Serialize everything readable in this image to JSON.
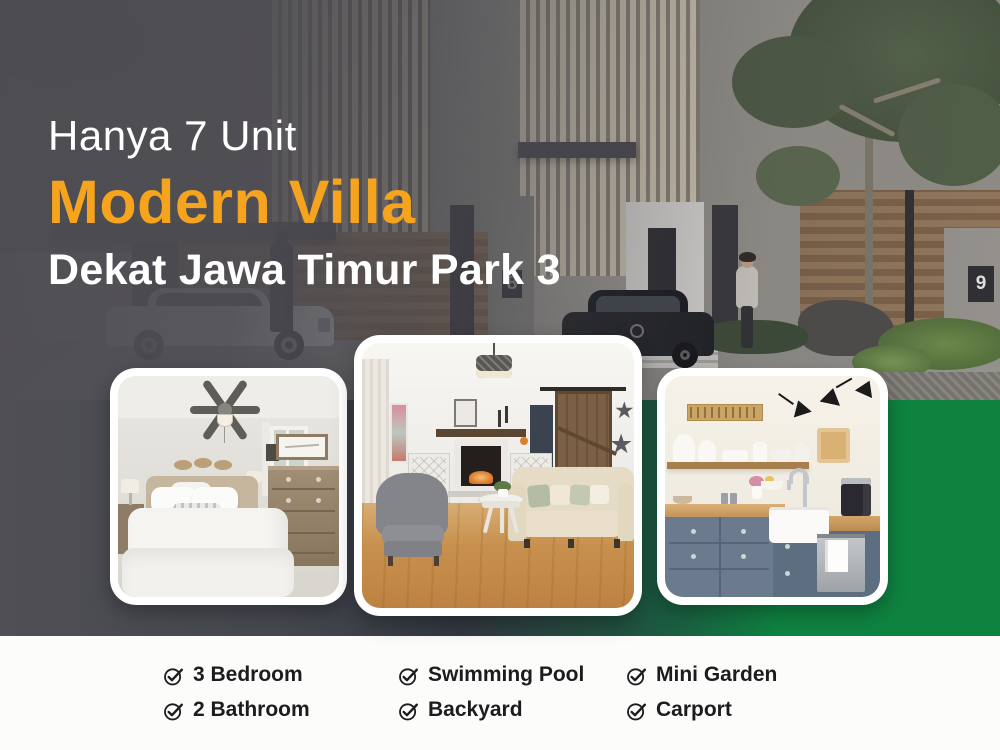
{
  "headline": {
    "kicker": "Hanya 7 Unit",
    "title": "Modern Villa",
    "subtitle": "Dekat Jawa Timur Park 3"
  },
  "hero": {
    "house_numbers": [
      "8",
      "9"
    ]
  },
  "features": {
    "items": [
      {
        "label": "3 Bedroom"
      },
      {
        "label": "Swimming Pool"
      },
      {
        "label": "Mini Garden"
      },
      {
        "label": "2 Bathroom"
      },
      {
        "label": "Backyard"
      },
      {
        "label": "Carport"
      }
    ]
  },
  "colors": {
    "accent_orange": "#F6A41E",
    "brand_green": "#0E8340",
    "overlay_gray": "#514F55",
    "slate_dark": "#3A3F4A",
    "footer_bg": "#FCFCFB",
    "text_dark": "#1C1C1E"
  }
}
